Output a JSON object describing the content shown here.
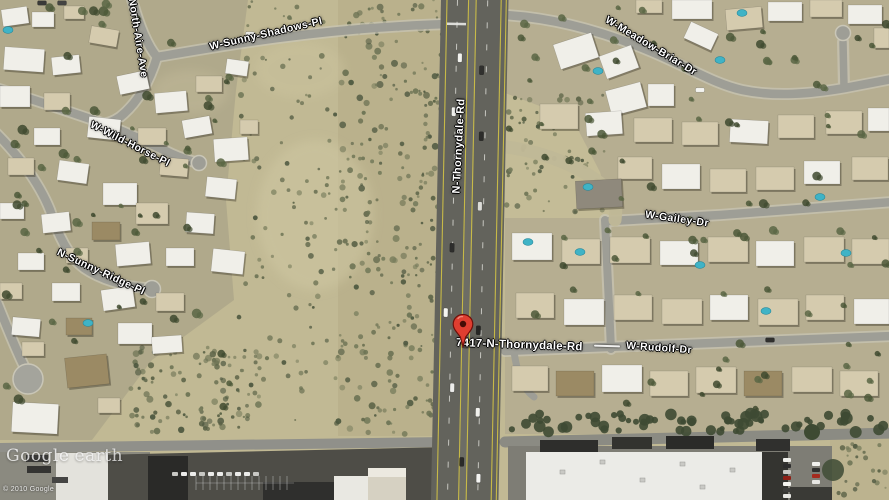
{
  "map": {
    "street_labels": {
      "north_aire": "North-Aire-Ave",
      "sunny_shadows": "W-Sunny-Shadows-Pl",
      "wild_horse": "W-Wild-Horse-Pl",
      "sunny_ridge": "N-Sunny-Ridge-Pl",
      "thornydale": "N-Thornydale-Rd",
      "meadow_briar": "W-Meadow-Briar-Dr",
      "gailey": "W-Gailey-Dr",
      "rudolf": "W-Rudolf-Dr"
    },
    "placemark": {
      "address_label": "7417-N-Thornydale-Rd",
      "pin_color": "#df3e30"
    },
    "branding": {
      "logo_primary": "Google",
      "logo_secondary": "earth",
      "copyright": "© 2010 Google"
    }
  }
}
